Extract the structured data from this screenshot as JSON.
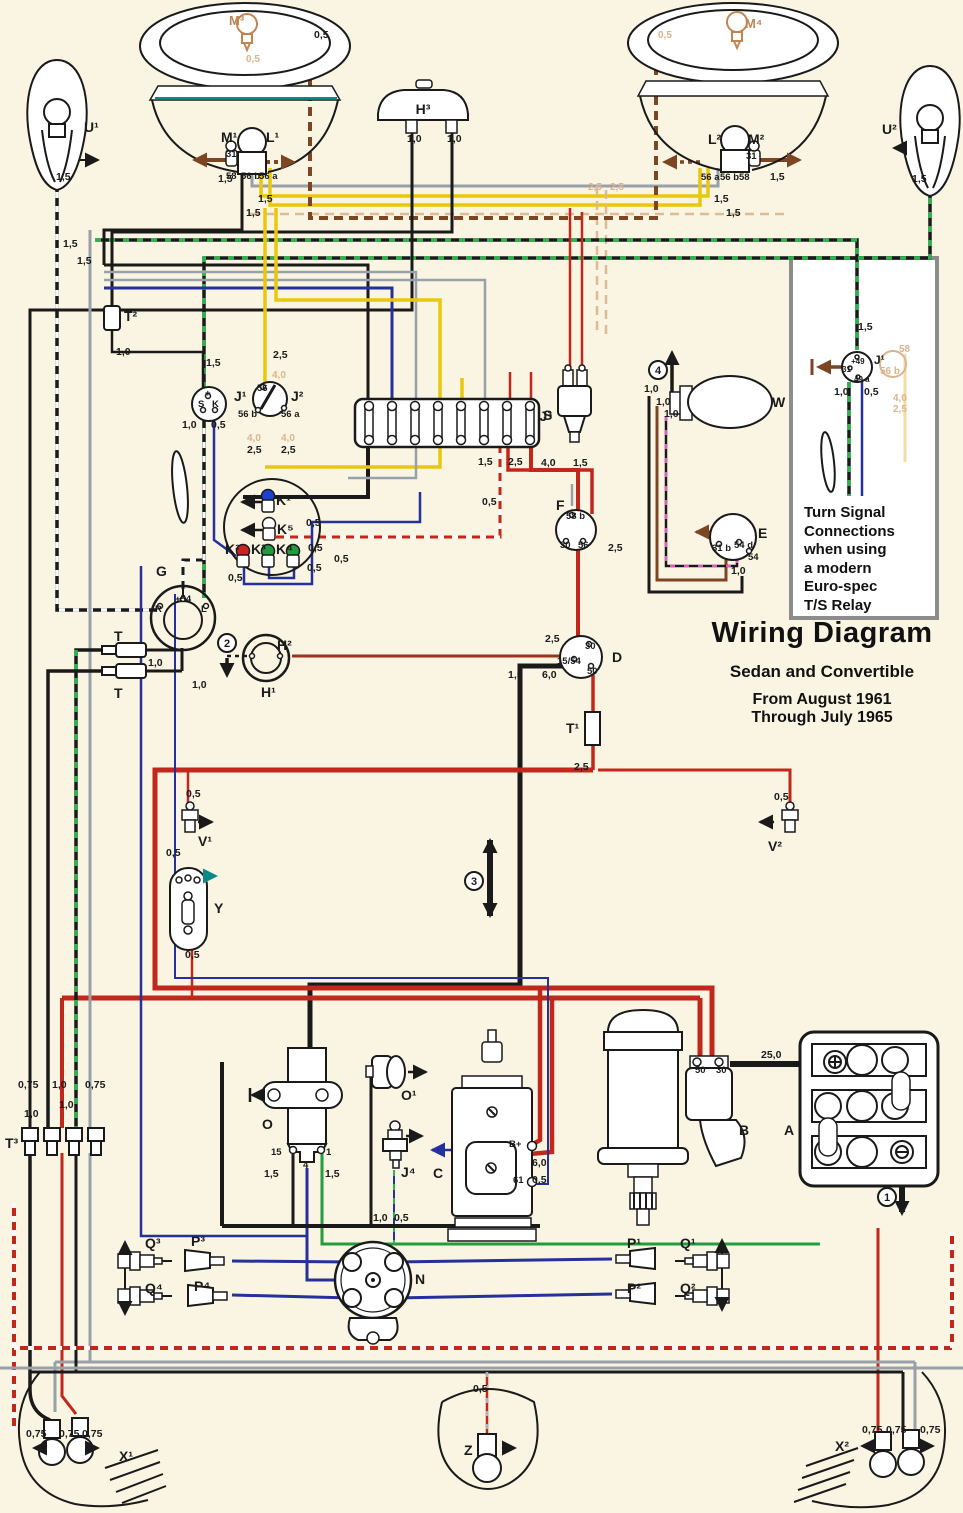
{
  "title": {
    "main": "Wiring Diagram",
    "sub": "Sedan and Convertible",
    "from": "From August 1961",
    "through": "Through July 1965"
  },
  "inset": {
    "lines": [
      "Turn Signal",
      "Connections",
      "when using",
      "a modern",
      "Euro-spec",
      "T/S Relay"
    ]
  },
  "palette": {
    "paper": "#faf5e2",
    "red": "#c2271c",
    "yellow": "#e9c70d",
    "grey": "#98a0aa",
    "brown": "#7c4524",
    "blue": "#25309b",
    "green": "#219c3e",
    "teal": "#0d8a86",
    "black": "#1a1a1a",
    "ghost_tan": "#dcb48c",
    "inset_border": "#8c8c8c"
  },
  "annotations": [
    {
      "t": "M³",
      "x": 229,
      "y": 25,
      "c": "ct",
      "n": "label-parking-bulb-left"
    },
    {
      "t": "M⁴",
      "x": 745,
      "y": 28,
      "c": "ct",
      "n": "label-parking-bulb-right"
    },
    {
      "t": "M¹",
      "x": 221,
      "y": 142,
      "c": "c"
    },
    {
      "t": "L¹",
      "x": 266,
      "y": 142,
      "c": "c"
    },
    {
      "t": "L²",
      "x": 708,
      "y": 144,
      "c": "c"
    },
    {
      "t": "M²",
      "x": 748,
      "y": 144,
      "c": "c"
    },
    {
      "t": "H³",
      "x": 423,
      "y": 114,
      "c": "c",
      "a": "middle",
      "n": "label-horn"
    },
    {
      "t": "U¹",
      "x": 84,
      "y": 132,
      "c": "c"
    },
    {
      "t": "U²",
      "x": 882,
      "y": 134,
      "c": "c"
    },
    {
      "t": "T²",
      "x": 124,
      "y": 321,
      "c": "c"
    },
    {
      "t": "J¹",
      "x": 234,
      "y": 401,
      "c": "c"
    },
    {
      "t": "J²",
      "x": 291,
      "y": 401,
      "c": "c"
    },
    {
      "t": "S",
      "x": 543,
      "y": 420,
      "c": "c",
      "n": "label-fusebox"
    },
    {
      "t": "J³",
      "x": 552,
      "y": 421,
      "c": "c",
      "a": "end"
    },
    {
      "t": "W",
      "x": 772,
      "y": 407,
      "c": "c",
      "n": "label-wiper-motor"
    },
    {
      "t": "E",
      "x": 758,
      "y": 538,
      "c": "c"
    },
    {
      "t": "F",
      "x": 556,
      "y": 510,
      "c": "c"
    },
    {
      "t": "K¹",
      "x": 276,
      "y": 505,
      "c": "c"
    },
    {
      "t": "K⁵",
      "x": 277,
      "y": 534,
      "c": "c"
    },
    {
      "t": "K²",
      "x": 225,
      "y": 554,
      "c": "c"
    },
    {
      "t": "K³",
      "x": 251,
      "y": 554,
      "c": "c"
    },
    {
      "t": "K⁴",
      "x": 276,
      "y": 554,
      "c": "c"
    },
    {
      "t": "G",
      "x": 156,
      "y": 576,
      "c": "c"
    },
    {
      "t": "T",
      "x": 114,
      "y": 641,
      "c": "c"
    },
    {
      "t": "T",
      "x": 114,
      "y": 698,
      "c": "c"
    },
    {
      "t": "H²",
      "x": 277,
      "y": 650,
      "c": "c"
    },
    {
      "t": "H¹",
      "x": 261,
      "y": 697,
      "c": "c"
    },
    {
      "t": "D",
      "x": 612,
      "y": 662,
      "c": "c",
      "n": "label-ignition-switch"
    },
    {
      "t": "T¹",
      "x": 566,
      "y": 733,
      "c": "c"
    },
    {
      "t": "V¹",
      "x": 198,
      "y": 846,
      "c": "c"
    },
    {
      "t": "Y",
      "x": 214,
      "y": 913,
      "c": "c"
    },
    {
      "t": "V²",
      "x": 768,
      "y": 851,
      "c": "c"
    },
    {
      "t": "O",
      "x": 262,
      "y": 1129,
      "c": "c",
      "n": "label-coil"
    },
    {
      "t": "O¹",
      "x": 401,
      "y": 1100,
      "c": "c"
    },
    {
      "t": "J⁴",
      "x": 401,
      "y": 1177,
      "c": "c"
    },
    {
      "t": "C",
      "x": 433,
      "y": 1178,
      "c": "c",
      "n": "label-generator"
    },
    {
      "t": "B",
      "x": 739,
      "y": 1135,
      "c": "c",
      "n": "label-starter"
    },
    {
      "t": "A",
      "x": 784,
      "y": 1135,
      "c": "c",
      "n": "label-battery"
    },
    {
      "t": "N",
      "x": 415,
      "y": 1284,
      "c": "c",
      "n": "label-distributor"
    },
    {
      "t": "P³",
      "x": 191,
      "y": 1246,
      "c": "c"
    },
    {
      "t": "P⁴",
      "x": 194,
      "y": 1291,
      "c": "c"
    },
    {
      "t": "Q³",
      "x": 145,
      "y": 1248,
      "c": "c"
    },
    {
      "t": "Q⁴",
      "x": 145,
      "y": 1293,
      "c": "c"
    },
    {
      "t": "P¹",
      "x": 627,
      "y": 1248,
      "c": "c"
    },
    {
      "t": "P²",
      "x": 627,
      "y": 1293,
      "c": "c"
    },
    {
      "t": "Q¹",
      "x": 680,
      "y": 1248,
      "c": "c"
    },
    {
      "t": "Q²",
      "x": 680,
      "y": 1293,
      "c": "c"
    },
    {
      "t": "T³",
      "x": 5,
      "y": 1148,
      "c": "c"
    },
    {
      "t": "X¹",
      "x": 119,
      "y": 1461,
      "c": "c"
    },
    {
      "t": "X²",
      "x": 835,
      "y": 1451,
      "c": "c"
    },
    {
      "t": "Z",
      "x": 464,
      "y": 1455,
      "c": "c",
      "n": "label-license-light"
    },
    {
      "t": "J¹",
      "x": 874,
      "y": 364,
      "c": "c2",
      "n": "label-inset-relay"
    },
    {
      "t": "31",
      "x": 226,
      "y": 157,
      "c": "t"
    },
    {
      "t": "58",
      "x": 226,
      "y": 179,
      "c": "t"
    },
    {
      "t": "56 b",
      "x": 241,
      "y": 179,
      "c": "t"
    },
    {
      "t": "56 a",
      "x": 259,
      "y": 179,
      "c": "t"
    },
    {
      "t": "56 a",
      "x": 701,
      "y": 180,
      "c": "t"
    },
    {
      "t": "56 b",
      "x": 720,
      "y": 180,
      "c": "t"
    },
    {
      "t": "58",
      "x": 739,
      "y": 180,
      "c": "t"
    },
    {
      "t": "31",
      "x": 746,
      "y": 159,
      "c": "t"
    },
    {
      "t": "+",
      "x": 205,
      "y": 396,
      "c": "t"
    },
    {
      "t": "S",
      "x": 198,
      "y": 407,
      "c": "t"
    },
    {
      "t": "K",
      "x": 212,
      "y": 407,
      "c": "t"
    },
    {
      "t": "56",
      "x": 257,
      "y": 391,
      "c": "t"
    },
    {
      "t": "56 b",
      "x": 238,
      "y": 417,
      "c": "t"
    },
    {
      "t": "56 a",
      "x": 281,
      "y": 417,
      "c": "t"
    },
    {
      "t": "31 b",
      "x": 712,
      "y": 551,
      "c": "t"
    },
    {
      "t": "54 d",
      "x": 734,
      "y": 548,
      "c": "t"
    },
    {
      "t": "54",
      "x": 748,
      "y": 560,
      "c": "t"
    },
    {
      "t": "58 b",
      "x": 566,
      "y": 519,
      "c": "t"
    },
    {
      "t": "30",
      "x": 560,
      "y": 548,
      "c": "t"
    },
    {
      "t": "56",
      "x": 578,
      "y": 548,
      "c": "t"
    },
    {
      "t": "+54",
      "x": 175,
      "y": 602,
      "c": "t"
    },
    {
      "t": "R",
      "x": 155,
      "y": 612,
      "c": "t"
    },
    {
      "t": "L",
      "x": 201,
      "y": 612,
      "c": "t"
    },
    {
      "t": "30",
      "x": 585,
      "y": 649,
      "c": "t"
    },
    {
      "t": "15/54",
      "x": 557,
      "y": 664,
      "c": "t"
    },
    {
      "t": "50",
      "x": 587,
      "y": 674,
      "c": "t"
    },
    {
      "t": "15",
      "x": 271,
      "y": 1155,
      "c": "t"
    },
    {
      "t": "4",
      "x": 303,
      "y": 1168,
      "c": "t"
    },
    {
      "t": "1",
      "x": 326,
      "y": 1155,
      "c": "t"
    },
    {
      "t": "B+",
      "x": 509,
      "y": 1147,
      "c": "t"
    },
    {
      "t": "61",
      "x": 513,
      "y": 1183,
      "c": "t"
    },
    {
      "t": "50",
      "x": 695,
      "y": 1073,
      "c": "t"
    },
    {
      "t": "30",
      "x": 716,
      "y": 1073,
      "c": "t"
    },
    {
      "t": "+49",
      "x": 851,
      "y": 364,
      "c": "ts"
    },
    {
      "t": "31",
      "x": 842,
      "y": 372,
      "c": "ts"
    },
    {
      "t": "49 a",
      "x": 854,
      "y": 382,
      "c": "ts"
    },
    {
      "t": "1,5",
      "x": 218,
      "y": 182,
      "c": "g"
    },
    {
      "t": "0,5",
      "x": 314,
      "y": 38,
      "c": "g"
    },
    {
      "t": "0,5",
      "x": 246,
      "y": 62,
      "c": "gh"
    },
    {
      "t": "1,5",
      "x": 258,
      "y": 202,
      "c": "g"
    },
    {
      "t": "1,5",
      "x": 246,
      "y": 216,
      "c": "g"
    },
    {
      "t": "0,5",
      "x": 658,
      "y": 38,
      "c": "gh"
    },
    {
      "t": "1,5",
      "x": 770,
      "y": 180,
      "c": "g"
    },
    {
      "t": "1,5",
      "x": 714,
      "y": 202,
      "c": "g"
    },
    {
      "t": "1,5",
      "x": 726,
      "y": 216,
      "c": "g"
    },
    {
      "t": "1,5",
      "x": 912,
      "y": 182,
      "c": "g"
    },
    {
      "t": "1,5",
      "x": 56,
      "y": 180,
      "c": "g"
    },
    {
      "t": "1,0",
      "x": 407,
      "y": 142,
      "c": "g"
    },
    {
      "t": "1,0",
      "x": 447,
      "y": 142,
      "c": "g"
    },
    {
      "t": "1,5",
      "x": 63,
      "y": 247,
      "c": "g"
    },
    {
      "t": "1,5",
      "x": 77,
      "y": 264,
      "c": "g"
    },
    {
      "t": "1,0",
      "x": 116,
      "y": 355,
      "c": "g"
    },
    {
      "t": "1,5",
      "x": 206,
      "y": 366,
      "c": "g"
    },
    {
      "t": "2,5",
      "x": 273,
      "y": 358,
      "c": "g"
    },
    {
      "t": "1,0",
      "x": 182,
      "y": 428,
      "c": "g"
    },
    {
      "t": "0,5",
      "x": 211,
      "y": 428,
      "c": "g"
    },
    {
      "t": "4,0",
      "x": 247,
      "y": 441,
      "c": "gh"
    },
    {
      "t": "4,0",
      "x": 281,
      "y": 441,
      "c": "gh"
    },
    {
      "t": "2,5",
      "x": 247,
      "y": 453,
      "c": "g"
    },
    {
      "t": "2,5",
      "x": 281,
      "y": 453,
      "c": "g"
    },
    {
      "t": "4,0",
      "x": 272,
      "y": 378,
      "c": "gh"
    },
    {
      "t": "1,5",
      "x": 478,
      "y": 465,
      "c": "g"
    },
    {
      "t": "2,5",
      "x": 508,
      "y": 465,
      "c": "g"
    },
    {
      "t": "4,0",
      "x": 541,
      "y": 466,
      "c": "g"
    },
    {
      "t": "1,5",
      "x": 573,
      "y": 466,
      "c": "g"
    },
    {
      "t": "0,5",
      "x": 482,
      "y": 505,
      "c": "g"
    },
    {
      "t": "2,5",
      "x": 608,
      "y": 551,
      "c": "g"
    },
    {
      "t": "0,5",
      "x": 306,
      "y": 526,
      "c": "g"
    },
    {
      "t": "0,5",
      "x": 308,
      "y": 551,
      "c": "g"
    },
    {
      "t": "0,5",
      "x": 334,
      "y": 562,
      "c": "g"
    },
    {
      "t": "0,5",
      "x": 307,
      "y": 571,
      "c": "g"
    },
    {
      "t": "0,5",
      "x": 228,
      "y": 581,
      "c": "g"
    },
    {
      "t": "1,0",
      "x": 148,
      "y": 666,
      "c": "g"
    },
    {
      "t": "1,0",
      "x": 192,
      "y": 688,
      "c": "g"
    },
    {
      "t": "2,5",
      "x": 545,
      "y": 642,
      "c": "g"
    },
    {
      "t": "1,5",
      "x": 508,
      "y": 678,
      "c": "g"
    },
    {
      "t": "6,0",
      "x": 542,
      "y": 678,
      "c": "g"
    },
    {
      "t": "2,5",
      "x": 574,
      "y": 770,
      "c": "g"
    },
    {
      "t": "0,5",
      "x": 186,
      "y": 797,
      "c": "g"
    },
    {
      "t": "0,5",
      "x": 166,
      "y": 856,
      "c": "g"
    },
    {
      "t": "0,5",
      "x": 185,
      "y": 958,
      "c": "g"
    },
    {
      "t": "0,5",
      "x": 774,
      "y": 800,
      "c": "g"
    },
    {
      "t": "1,0",
      "x": 644,
      "y": 392,
      "c": "g"
    },
    {
      "t": "1,0",
      "x": 656,
      "y": 405,
      "c": "g"
    },
    {
      "t": "1,0",
      "x": 664,
      "y": 417,
      "c": "g"
    },
    {
      "t": "1,0",
      "x": 731,
      "y": 574,
      "c": "g"
    },
    {
      "t": "1,5",
      "x": 264,
      "y": 1177,
      "c": "g"
    },
    {
      "t": "1,5",
      "x": 325,
      "y": 1177,
      "c": "g"
    },
    {
      "t": "1,0",
      "x": 373,
      "y": 1221,
      "c": "g"
    },
    {
      "t": "0,5",
      "x": 394,
      "y": 1221,
      "c": "g"
    },
    {
      "t": "6,0",
      "x": 532,
      "y": 1166,
      "c": "g"
    },
    {
      "t": "0,5",
      "x": 532,
      "y": 1183,
      "c": "g"
    },
    {
      "t": "25,0",
      "x": 761,
      "y": 1058,
      "c": "g"
    },
    {
      "t": "0,75",
      "x": 18,
      "y": 1088,
      "c": "g"
    },
    {
      "t": "1,0",
      "x": 52,
      "y": 1088,
      "c": "g"
    },
    {
      "t": "1,0",
      "x": 59,
      "y": 1108,
      "c": "g"
    },
    {
      "t": "0,75",
      "x": 85,
      "y": 1088,
      "c": "g"
    },
    {
      "t": "1,0",
      "x": 24,
      "y": 1117,
      "c": "g"
    },
    {
      "t": "0,75",
      "x": 26,
      "y": 1437,
      "c": "g"
    },
    {
      "t": "0,75",
      "x": 59,
      "y": 1437,
      "c": "g"
    },
    {
      "t": "0,75",
      "x": 82,
      "y": 1437,
      "c": "g"
    },
    {
      "t": "0,75",
      "x": 862,
      "y": 1433,
      "c": "g"
    },
    {
      "t": "0,75",
      "x": 886,
      "y": 1433,
      "c": "g"
    },
    {
      "t": "0,75",
      "x": 920,
      "y": 1433,
      "c": "g"
    },
    {
      "t": "0,5",
      "x": 473,
      "y": 1392,
      "c": "g"
    },
    {
      "t": "1,5",
      "x": 858,
      "y": 330,
      "c": "g"
    },
    {
      "t": "1,0",
      "x": 834,
      "y": 395,
      "c": "g"
    },
    {
      "t": "0,5",
      "x": 864,
      "y": 395,
      "c": "g"
    },
    {
      "t": "2,5",
      "x": 588,
      "y": 190,
      "c": "gh"
    },
    {
      "t": "2,5",
      "x": 610,
      "y": 190,
      "c": "gh"
    },
    {
      "t": "58",
      "x": 899,
      "y": 352,
      "c": "gh"
    },
    {
      "t": "56 b",
      "x": 880,
      "y": 374,
      "c": "gh"
    },
    {
      "t": "4,0",
      "x": 893,
      "y": 401,
      "c": "gh"
    },
    {
      "t": "2,5",
      "x": 893,
      "y": 412,
      "c": "gh"
    }
  ],
  "circled_numbers": [
    {
      "t": "1",
      "x": 887,
      "y": 1197
    },
    {
      "t": "2",
      "x": 227,
      "y": 643
    },
    {
      "t": "3",
      "x": 474,
      "y": 881
    },
    {
      "t": "4",
      "x": 658,
      "y": 370
    }
  ]
}
